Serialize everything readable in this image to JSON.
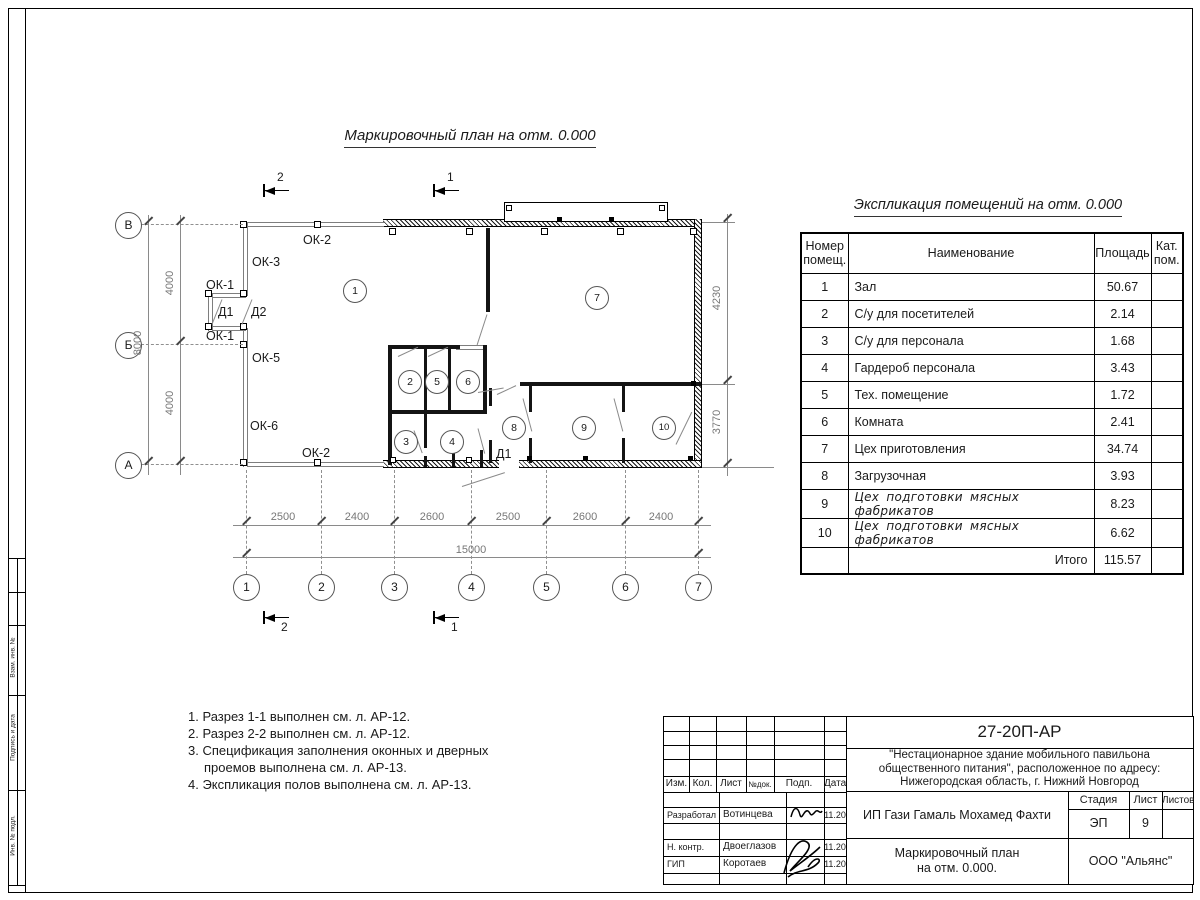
{
  "titles": {
    "plan_title": "Маркировочный план на отм. 0.000",
    "table_title": "Экспликация помещений на отм. 0.000"
  },
  "room_table": {
    "headers": {
      "num": "Номер\nпомещ.",
      "name": "Наименование",
      "area": "Площадь",
      "cat": "Кат.\nпом."
    },
    "rows": [
      {
        "num": "1",
        "name": "Зал",
        "area": "50.67"
      },
      {
        "num": "2",
        "name": "С/у для посетителей",
        "area": "2.14"
      },
      {
        "num": "3",
        "name": "С/у для персонала",
        "area": "1.68"
      },
      {
        "num": "4",
        "name": "Гардероб персонала",
        "area": "3.43"
      },
      {
        "num": "5",
        "name": "Тех. помещение",
        "area": "1.72"
      },
      {
        "num": "6",
        "name": "Комната",
        "area": "2.41"
      },
      {
        "num": "7",
        "name": "Цех приготовления",
        "area": "34.74"
      },
      {
        "num": "8",
        "name": "Загрузочная",
        "area": "3.93"
      },
      {
        "num": "9",
        "name": "Цех подготовки мясных фабрикатов",
        "area": "8.23"
      },
      {
        "num": "10",
        "name": "Цех подготовки мясных фабрикатов",
        "area": "6.62"
      }
    ],
    "total_label": "Итого",
    "total_value": "115.57"
  },
  "notes": [
    "1. Разрез 1-1 выполнен см. л. АР-12.",
    "2. Разрез 2-2 выполнен см. л. АР-12.",
    "3. Спецификация заполнения оконных и дверных проемов выполнена см. л. АР-13.",
    "4. Экспликация полов выполнена см. л. АР-13."
  ],
  "plan": {
    "grid_cols": [
      "1",
      "2",
      "3",
      "4",
      "5",
      "6",
      "7"
    ],
    "grid_rows": [
      "В",
      "Б",
      "А"
    ],
    "room_numbers": [
      "1",
      "2",
      "3",
      "4",
      "5",
      "6",
      "7",
      "8",
      "9",
      "10"
    ],
    "labels": {
      "ok2_top": "ОК-2",
      "ok3": "ОК-3",
      "ok1_top": "ОК-1",
      "d1_vest": "Д1",
      "d2_vest": "Д2",
      "ok1_bot": "ОК-1",
      "ok5": "ОК-5",
      "ok6": "ОК-6",
      "ok2_bot": "ОК-2",
      "d1_right": "Д1"
    },
    "dims_bottom": [
      "2500",
      "2400",
      "2600",
      "2500",
      "2600",
      "2400"
    ],
    "dim_total": "15000",
    "dims_left": [
      "4000",
      "4000"
    ],
    "dim_left_total": "8000",
    "dims_right": [
      "4230",
      "3770"
    ],
    "section_marks": {
      "s1": "1",
      "s2": "2"
    }
  },
  "title_block": {
    "doc_number": "27-20П-АР",
    "project_lines": "\"Нестационарное здание мобильного павильона\nобщественного питания\", расположенное по адресу:\nНижегородская область, г. Нижний Новгород",
    "header_cols": [
      "Изм.",
      "Кол.",
      "Лист",
      "№док.",
      "Подп.",
      "Дата"
    ],
    "rows": [
      {
        "role": "Разработал",
        "name": "Вотинцева",
        "date": "11.20"
      },
      {
        "role": "Н. контр.",
        "name": "Двоеглазов",
        "date": "11.20"
      },
      {
        "role": "ГИП",
        "name": "Коротаев",
        "date": "11.20"
      }
    ],
    "client": "ИП Гази Гамаль Мохамед Фахти",
    "stage_label": "Стадия",
    "sheet_label": "Лист",
    "sheets_label": "Листов",
    "stage": "ЭП",
    "sheet": "9",
    "drawing_name": "Маркировочный план\nна отм. 0.000.",
    "company": "ООО \"Альянс\""
  },
  "side_stamp": [
    "Взам. инв. №",
    "Подпись и дата",
    "Инв. № подл."
  ]
}
